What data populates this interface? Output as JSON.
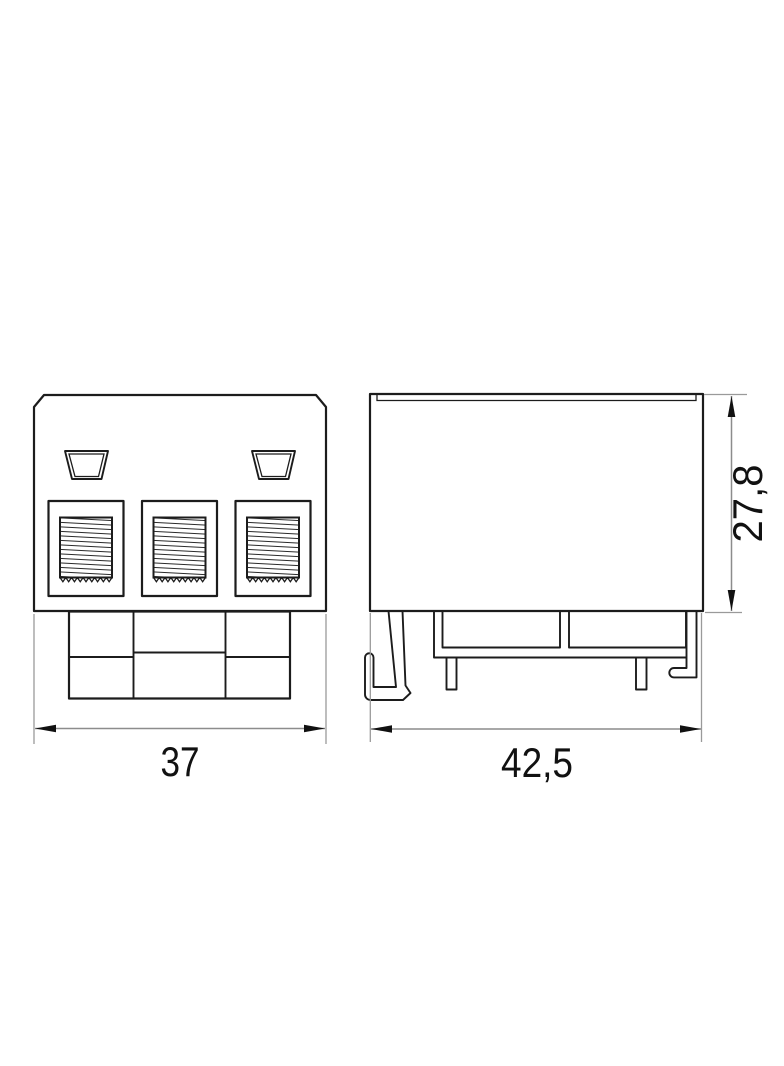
{
  "page": {
    "background": "#ffffff"
  },
  "drawing": {
    "colors": {
      "line": "#1c1c1c",
      "dimension_line": "#8c8c8c",
      "text": "#111111"
    },
    "dimensions": {
      "front_width": "37",
      "side_width": "42,5",
      "side_height": "27,8"
    }
  }
}
